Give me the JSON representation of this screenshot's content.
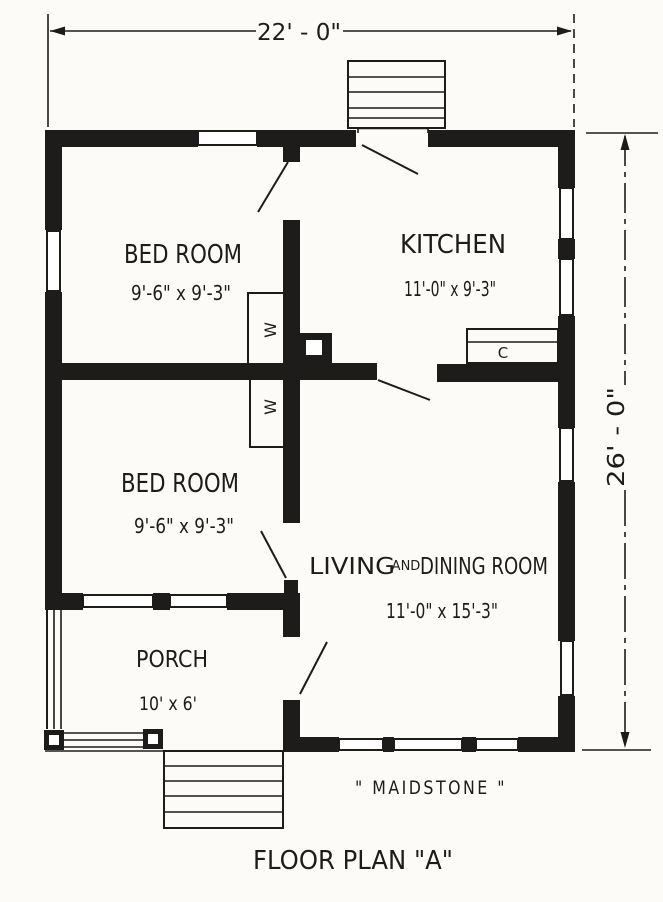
{
  "plan": {
    "title": "FLOOR PLAN \"A\"",
    "house_name": "\" MAIDSTONE \"",
    "overall_width": "22' - 0\"",
    "overall_depth": "26' - 0\"",
    "rooms": {
      "bedroom_upper": {
        "name": "BED ROOM",
        "size": "9'-6\" x 9'-3\""
      },
      "kitchen": {
        "name": "KITCHEN",
        "size": "11'-0\" x 9'-3\""
      },
      "bedroom_lower": {
        "name": "BED ROOM",
        "size": "9'-6\" x 9'-3\""
      },
      "living_dining": {
        "word1": "LIVING",
        "conj": "AND",
        "word2": "DINING ROOM",
        "size": "11'-0\" x 15'-3\""
      },
      "porch": {
        "name": "PORCH",
        "size": "10' x 6'"
      }
    },
    "closets": {
      "wardrobe_upper": "W",
      "wardrobe_lower": "W",
      "kitchen_cupboard": "C"
    },
    "colors": {
      "ink": "#1e1c1a",
      "paper": "#fcfbf8"
    }
  }
}
